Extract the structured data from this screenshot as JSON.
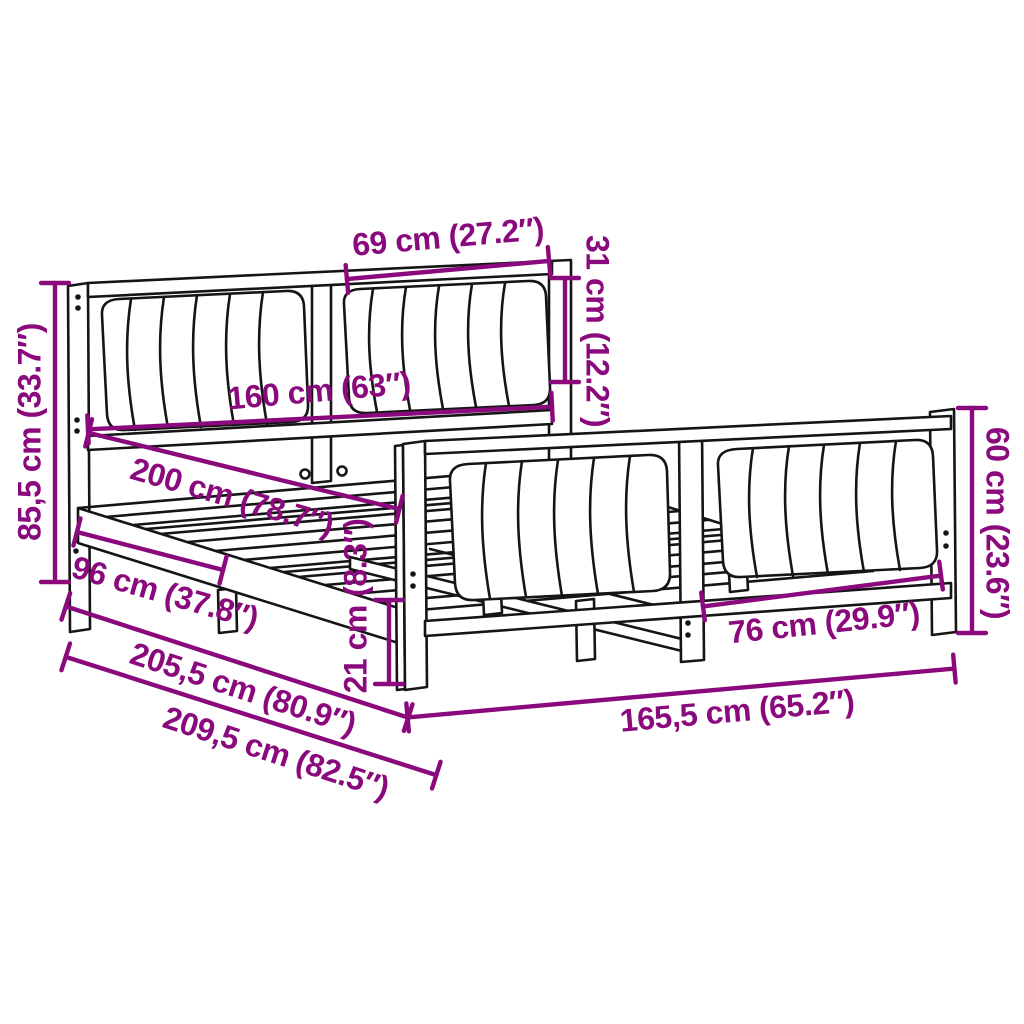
{
  "figure": "bed-frame-dimension-diagram",
  "colors": {
    "dimension": "#8a0a7d",
    "line": "#151515",
    "background": "#ffffff"
  },
  "dimensions": [
    {
      "id": "headboard-cushion-width",
      "label": "69 cm (27.2″)"
    },
    {
      "id": "headboard-cushion-height",
      "label": "31 cm (12.2″)"
    },
    {
      "id": "bed-width",
      "label": "160 cm (63″)"
    },
    {
      "id": "bed-length-inner",
      "label": "200 cm (78.7″)"
    },
    {
      "id": "headboard-height",
      "label": "85,5 cm (33.7″)"
    },
    {
      "id": "side-rail-span",
      "label": "96 cm (37.8″)"
    },
    {
      "id": "frame-length",
      "label": "205,5 cm (80.9″)"
    },
    {
      "id": "total-length",
      "label": "209,5 cm (82.5″)"
    },
    {
      "id": "underbed-clearance",
      "label": "21 cm (8.3″)"
    },
    {
      "id": "footboard-width",
      "label": "165,5 cm (65.2″)"
    },
    {
      "id": "footboard-cushion-width",
      "label": "76 cm (29.9″)"
    },
    {
      "id": "footboard-height",
      "label": "60 cm (23.6″)"
    }
  ]
}
